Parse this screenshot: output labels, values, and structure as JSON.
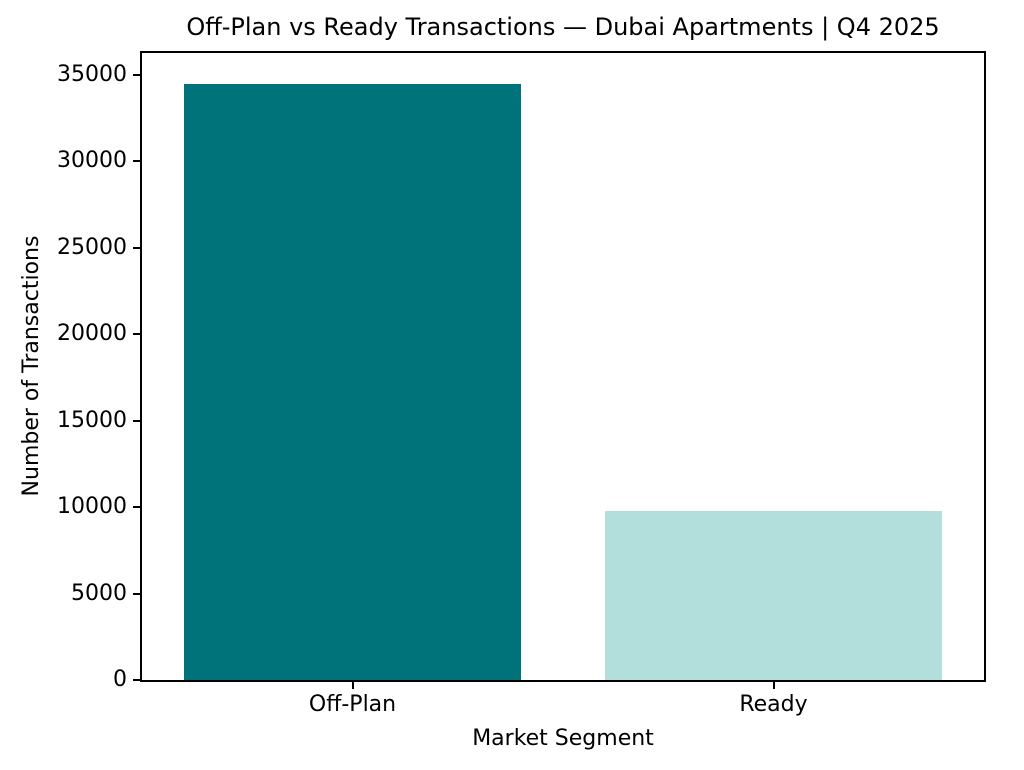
{
  "chart_data": {
    "type": "bar",
    "title": "Off-Plan vs Ready Transactions — Dubai Apartments | Q4 2025",
    "xlabel": "Market Segment",
    "ylabel": "Number of Transactions",
    "categories": [
      "Off-Plan",
      "Ready"
    ],
    "values": [
      34500,
      9800
    ],
    "bar_colors": [
      "#00737a",
      "#b2dfdb"
    ],
    "yticks": [
      0,
      5000,
      10000,
      15000,
      20000,
      25000,
      30000,
      35000
    ],
    "ylim": [
      0,
      36270
    ],
    "grid": false,
    "legend_position": "none",
    "text_color": "#000000",
    "spine_color": "#000000",
    "background_color": "#ffffff"
  }
}
